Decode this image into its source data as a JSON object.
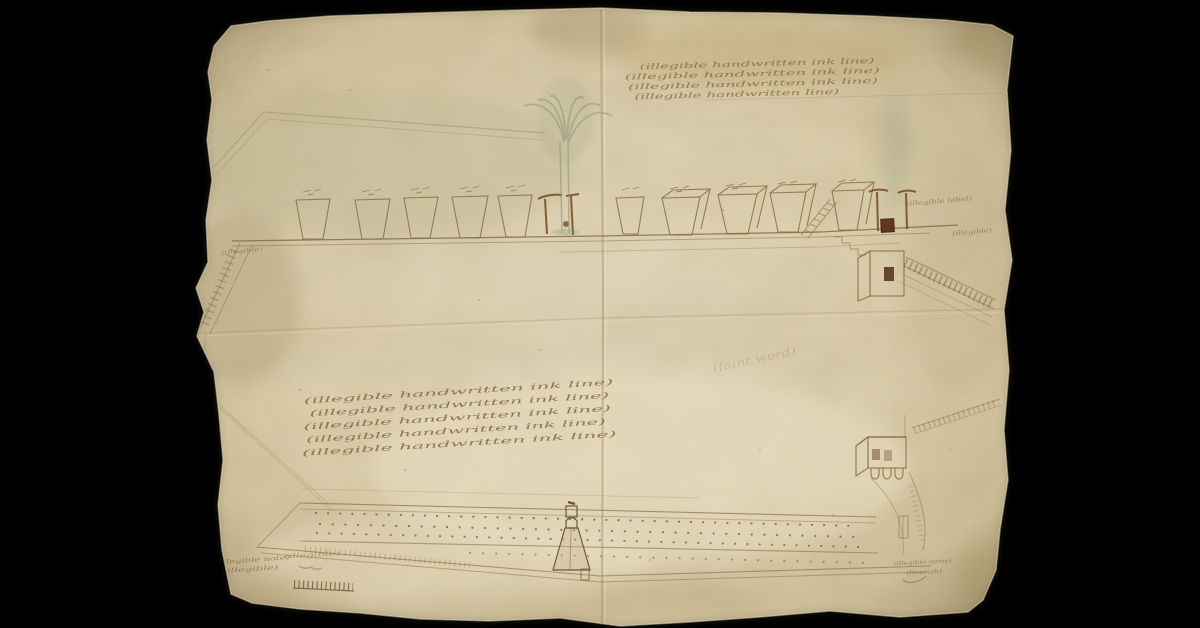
{
  "scene": {
    "description": "Digitized early-modern manuscript engineering drawing in brown ink on aged parchment, photographed on a black backdrop",
    "background_color": "#000000"
  },
  "palette": {
    "paper": "#dacca6",
    "paper_light": "#e8debd",
    "paper_dark": "#b9a87f",
    "ink": "#8a6f42",
    "ink_dark": "#5c3a1d",
    "wash_green": "#8f9877"
  },
  "upper_view": {
    "caisson_count": 10,
    "note": "elevation of a sea-wall: row of timber caissons on a baseline, water plume at centre, steps, sluice house and piled jetty at right"
  },
  "lower_view": {
    "note": "plan of the same breakwater: long band with rows of pile dots, small central turret, sluice house and shoreline at right"
  },
  "annotations": {
    "top_note": {
      "lines": [
        "(illegible handwritten ink line)",
        "(illegible handwritten ink line)",
        "(illegible handwritten ink line)",
        "(illegible handwritten line)"
      ]
    },
    "bank_label": {
      "text": "(illegible)"
    },
    "right_label_upper": {
      "text": "(illegible label)"
    },
    "right_label_lower": {
      "text": "(illegible)"
    },
    "center_note": {
      "lines": [
        "(illegible handwritten ink line)",
        "(illegible handwritten ink line)",
        "(illegible handwritten ink line)",
        "(illegible handwritten ink line)",
        "(illegible handwritten ink line)"
      ]
    },
    "faint_center_word": {
      "text": "(faint word)"
    },
    "bottom_left_note": {
      "lines": [
        "(illegible note)",
        "(illegible)"
      ]
    },
    "scale_note": {
      "text": "(illegible)"
    },
    "signature": {
      "lines": [
        "(illegible name)",
        "(flourish)"
      ]
    },
    "caisson_marks_note": "(tiny illegible measurement scribbles above each caisson)",
    "scale_bar_ticks": 13
  }
}
